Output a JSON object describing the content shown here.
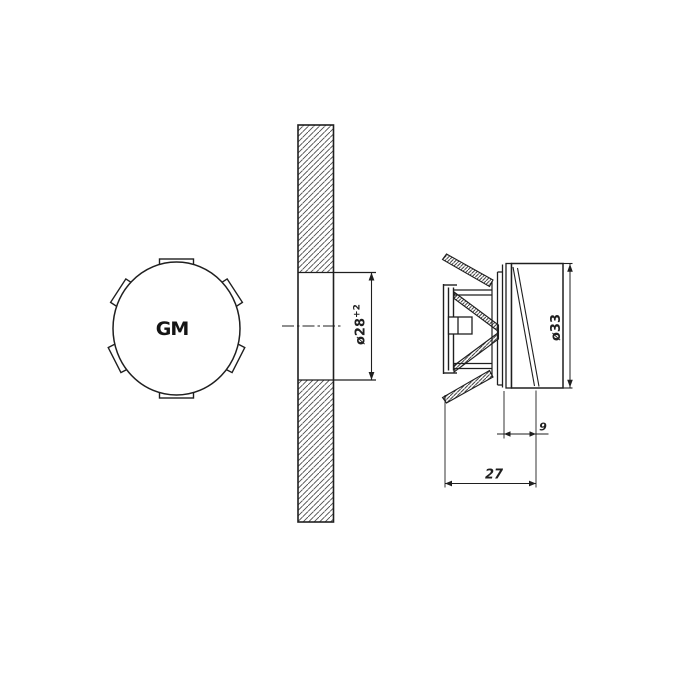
{
  "drawing": {
    "type": "technical-drawing",
    "views": {
      "front": {
        "logo": "GM"
      },
      "section": {
        "hole_dim": "ø28",
        "hole_tol": "+2"
      },
      "side": {
        "plate_dim": "ø33",
        "depth_dim": "9",
        "total_depth_dim": "27"
      }
    },
    "colors": {
      "line": "#1f1f1f",
      "background": "#ffffff",
      "hatch": "#4a4a4a"
    }
  }
}
